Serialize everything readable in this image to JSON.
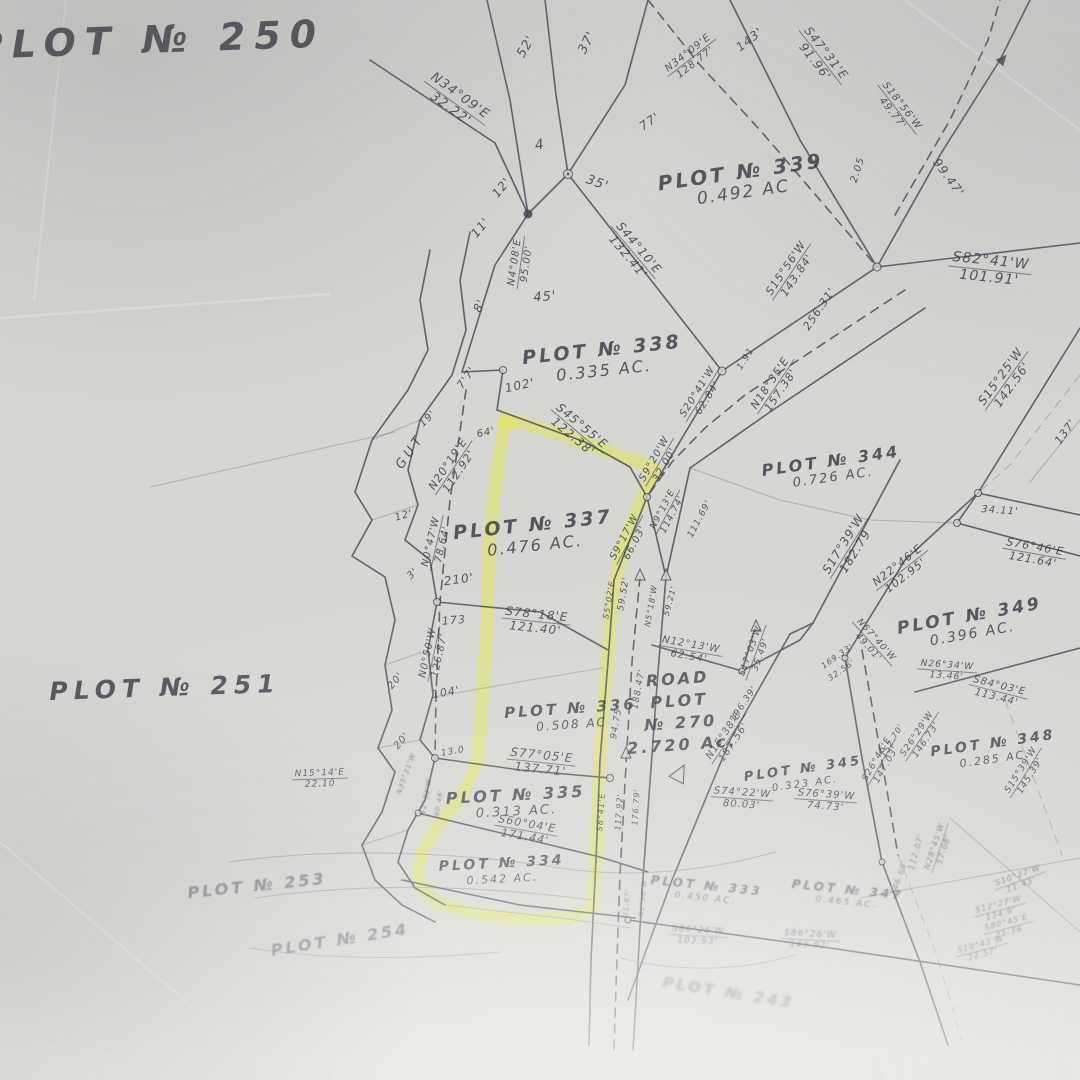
{
  "colors": {
    "paper": "#d6d6d2",
    "ink": "#40414a",
    "text": "#35363f",
    "highlight": "#e3e84e"
  },
  "highlight_encircles": [
    "PLOT № 337",
    "PLOT № 336",
    "PLOT № 335",
    "PLOT № 334"
  ],
  "plots": [
    {
      "name": "PLOT № 250",
      "area": ""
    },
    {
      "name": "PLOT № 339",
      "area": "0.492 AC"
    },
    {
      "name": "PLOT № 338",
      "area": "0.335 AC."
    },
    {
      "name": "PLOT № 337",
      "area": "0.476 AC."
    },
    {
      "name": "PLOT № 344",
      "area": "0.726 AC."
    },
    {
      "name": "PLOT № 251",
      "area": ""
    },
    {
      "name": "PLOT № 336",
      "area": "0.508 AC"
    },
    {
      "name": "PLOT № 349",
      "area": "0.396 AC."
    },
    {
      "name": "PLOT № 348",
      "area": "0.285 AC."
    },
    {
      "name": "PLOT № 345",
      "area": "0.323 AC."
    },
    {
      "name": "PLOT № 335",
      "area": "0.313 AC."
    },
    {
      "name": "PLOT № 334",
      "area": "0.542 AC."
    },
    {
      "name": "PLOT № 253",
      "area": ""
    },
    {
      "name": "PLOT № 254",
      "area": ""
    },
    {
      "name": "PLOT № 333",
      "area": "0.450 AC."
    },
    {
      "name": "PLOT № 347",
      "area": "0.465 AC."
    },
    {
      "name": "PLOT № 243",
      "area": ""
    }
  ],
  "road": {
    "lines": [
      "ROAD",
      "PLOT",
      "№ 270",
      "2.720 Ac."
    ]
  },
  "bearings": [
    {
      "bearing": "N34°09'E",
      "distance": "32.22'"
    },
    {
      "bearing": "N34°09'E",
      "distance": "128.77'"
    },
    {
      "bearing": "S47°31'E",
      "distance": "91.96'"
    },
    {
      "bearing": "S18°56'W",
      "distance": "49.77'"
    },
    {
      "bearing": "S44°10'E",
      "distance": "132.41'"
    },
    {
      "bearing": "N4°08'E",
      "distance": "95.00'"
    },
    {
      "bearing": "S82°41'W",
      "distance": "101.91'"
    },
    {
      "bearing": "S15°56'W",
      "distance": "143.84'"
    },
    {
      "bearing": "N18°35'E",
      "distance": "157.38'"
    },
    {
      "bearing": "S15°25'W",
      "distance": "142.56'"
    },
    {
      "bearing": "S20°41'W",
      "distance": "62.84'"
    },
    {
      "bearing": "S45°55'E",
      "distance": "122.38'"
    },
    {
      "bearing": "N20°19'E",
      "distance": "112.92'"
    },
    {
      "bearing": "N0°47'W",
      "distance": "78.64'"
    },
    {
      "bearing": "S9°20'W",
      "distance": "32.00'"
    },
    {
      "bearing": "S9°17'W",
      "distance": "66.03'"
    },
    {
      "bearing": "N9°13'E",
      "distance": "114.74'"
    },
    {
      "bearing": "S78°18'E",
      "distance": "121.40'"
    },
    {
      "bearing": "N0°50'W",
      "distance": "126.87'"
    },
    {
      "bearing": "S77°05'E",
      "distance": "137.71'"
    },
    {
      "bearing": "N15°14'E",
      "distance": "22.10"
    },
    {
      "bearing": "S60°04'E",
      "distance": "171.44'"
    },
    {
      "bearing": "N12°13'W",
      "distance": "62.54'"
    },
    {
      "bearing": "S17°03'W",
      "distance": "35.49'"
    },
    {
      "bearing": "N16°38'E",
      "distance": "187.56'"
    },
    {
      "bearing": "S74°22'W",
      "distance": "80.03'"
    },
    {
      "bearing": "S76°39'W",
      "distance": "74.73'"
    },
    {
      "bearing": "N57°40'W",
      "distance": "49.01'"
    },
    {
      "bearing": "N26°34'W",
      "distance": "13.46'"
    },
    {
      "bearing": "S84°03'E",
      "distance": "113.44'"
    },
    {
      "bearing": "S26°29'W",
      "distance": "146.73'"
    },
    {
      "bearing": "S26°46'E",
      "distance": "147.03'"
    },
    {
      "bearing": "S15°39'W",
      "distance": "145.39'"
    },
    {
      "bearing": "S76°46'E",
      "distance": "121.64'"
    },
    {
      "bearing": "N22°46'E",
      "distance": "102.95'"
    },
    {
      "bearing": "S17°39'W",
      "distance": "182.79"
    },
    {
      "bearing": "S86°26'W",
      "distance": "103.93'"
    },
    {
      "bearing": "S86°26'W",
      "distance": "143.92'"
    },
    {
      "bearing": "S10°27'W",
      "distance": "11.43'"
    },
    {
      "bearing": "S12°27'W",
      "distance": "134.9'"
    },
    {
      "bearing": "S80°45'E",
      "distance": "21.36"
    },
    {
      "bearing": "S10°43'W",
      "distance": "22.57'"
    },
    {
      "bearing": "N28°45'W",
      "distance": "57.08'"
    }
  ],
  "ticks": [
    "52'",
    "37'",
    "4",
    "35'",
    "12'",
    "11'",
    "143'",
    "77'",
    "2.05",
    "99.47'",
    "45'",
    "8'",
    "7'7'",
    "102'",
    "256.31'",
    "1.91",
    "137'",
    "19'",
    "64'",
    "GUT",
    "12'",
    "3'",
    "210'",
    "173",
    "111.69'",
    "59.52'",
    "N5°18'W",
    "59.21'",
    "S5°02'E",
    "20'",
    "104'",
    "20'",
    "13.0",
    "196.39'",
    "188.47'",
    "94.75'",
    "169.33'",
    "32.56'",
    "152.70'",
    "34.11'",
    "N2°32'W",
    "40.46'",
    "N35°21'W",
    "S8°41'E",
    "117.92'",
    "176.79'",
    "31.67'",
    "S1°36'W",
    "112.07'",
    "146.68'"
  ]
}
